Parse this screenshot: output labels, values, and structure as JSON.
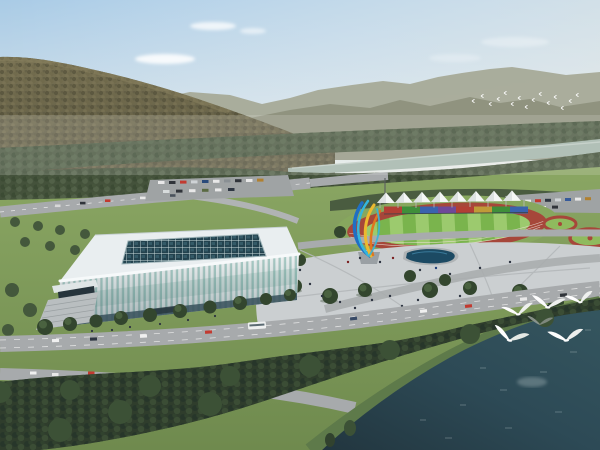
{
  "meta": {
    "kind": "architectural-rendering",
    "subject": "aerial rendering of riverside sports complex: glass arena, outdoor running track with white canopy tents, plaza with sculpture and pond, boulevards, forested mountains, river and lake with white birds"
  },
  "scene": {
    "sky_top": "#a9cbe6",
    "sky_horizon": "#eceee7",
    "cloud": "#ffffff",
    "mountain_near": "#6f684c",
    "mountain_shade": "#5a573e",
    "ridge_far": "#a6aa98",
    "ridge_mid": "#8d907c",
    "treeband": "#4c5a42",
    "treeband_low": "#44523b",
    "river": "#a4b6ac",
    "lawn_top": "#8aa663",
    "lawn_bottom": "#6f8a4e",
    "road": "#a7aaac",
    "parking": "#9fa3a4",
    "hedge": "#4a5c40",
    "plaza": "#cbcfd1",
    "pond": "#1c4a63",
    "track_ring": "#a6473a",
    "track_lawn": "#87a75e",
    "infield_light": "#9cca6e",
    "infield_dark": "#7ab44d",
    "tent": "#f4f6f6",
    "tent_shade": "#dde2e2",
    "panels": [
      "#b23f35",
      "#3f8f3a",
      "#3a63ae",
      "#6f4899",
      "#b23f35",
      "#c09a38",
      "#3f8f3a",
      "#3a63ae"
    ],
    "stadium_roof": "#e9eef0",
    "stadium_rim": "#f6f9fa",
    "stadium_glass": "#a9ccc6",
    "skylight": "#23424e",
    "skylight_grid": "#cfe0e0",
    "stadium_base": "#37505a",
    "stairs": "#b9bec0",
    "sculpture_blue": "#1f6fc4",
    "sculpture_cyan": "#35b6dc",
    "sculpture_yellow": "#ecb92f",
    "sculpture_orange": "#e0761f",
    "tree_dark": "#33462e",
    "tree_light": "#4a6240",
    "forest": "#2f3d2c",
    "shore_grass": "#5e7a4a",
    "water": "#2d4a56",
    "water_deep": "#22363f",
    "bird": "#fdfdfd",
    "bus": "#eef0f0",
    "car_red": "#c23a30",
    "people": "#2c3340"
  }
}
